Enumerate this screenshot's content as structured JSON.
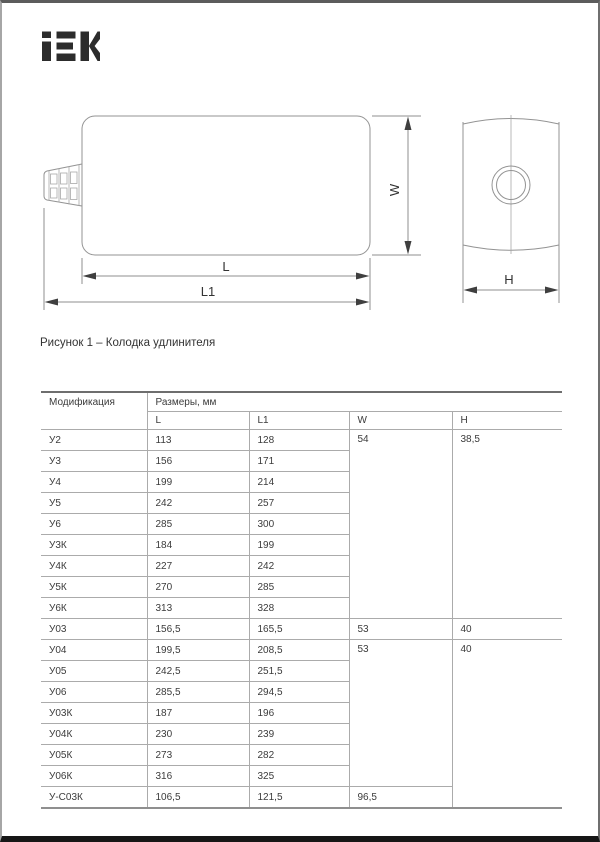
{
  "page": {
    "logo_text": "iEK",
    "figure_caption": "Рисунок 1 – Колодка удлинителя"
  },
  "drawing": {
    "labels": {
      "length": "L",
      "length_total": "L1",
      "width": "W",
      "height": "H"
    }
  },
  "table": {
    "header": {
      "modification": "Модификация",
      "dimensions_group": "Размеры, мм",
      "columns": [
        "L",
        "L1",
        "W",
        "H"
      ]
    },
    "rows": [
      {
        "model": "У2",
        "l": "113",
        "l1": "128",
        "w": "54",
        "h": "38,5"
      },
      {
        "model": "У3",
        "l": "156",
        "l1": "171"
      },
      {
        "model": "У4",
        "l": "199",
        "l1": "214"
      },
      {
        "model": "У5",
        "l": "242",
        "l1": "257"
      },
      {
        "model": "У6",
        "l": "285",
        "l1": "300"
      },
      {
        "model": "У3К",
        "l": "184",
        "l1": "199"
      },
      {
        "model": "У4К",
        "l": "227",
        "l1": "242"
      },
      {
        "model": "У5К",
        "l": "270",
        "l1": "285"
      },
      {
        "model": "У6К",
        "l": "313",
        "l1": "328"
      },
      {
        "model": "У03",
        "l": "156,5",
        "l1": "165,5",
        "w": "53",
        "h": "40"
      },
      {
        "model": "У04",
        "l": "199,5",
        "l1": "208,5",
        "w": "53",
        "h": "40"
      },
      {
        "model": "У05",
        "l": "242,5",
        "l1": "251,5"
      },
      {
        "model": "У06",
        "l": "285,5",
        "l1": "294,5"
      },
      {
        "model": "У03К",
        "l": "187",
        "l1": "196"
      },
      {
        "model": "У04К",
        "l": "230",
        "l1": "239"
      },
      {
        "model": "У05К",
        "l": "273",
        "l1": "282"
      },
      {
        "model": "У06К",
        "l": "316",
        "l1": "325"
      },
      {
        "model": "У-С03К",
        "l": "106,5",
        "l1": "121,5",
        "w": "96,5"
      }
    ]
  }
}
